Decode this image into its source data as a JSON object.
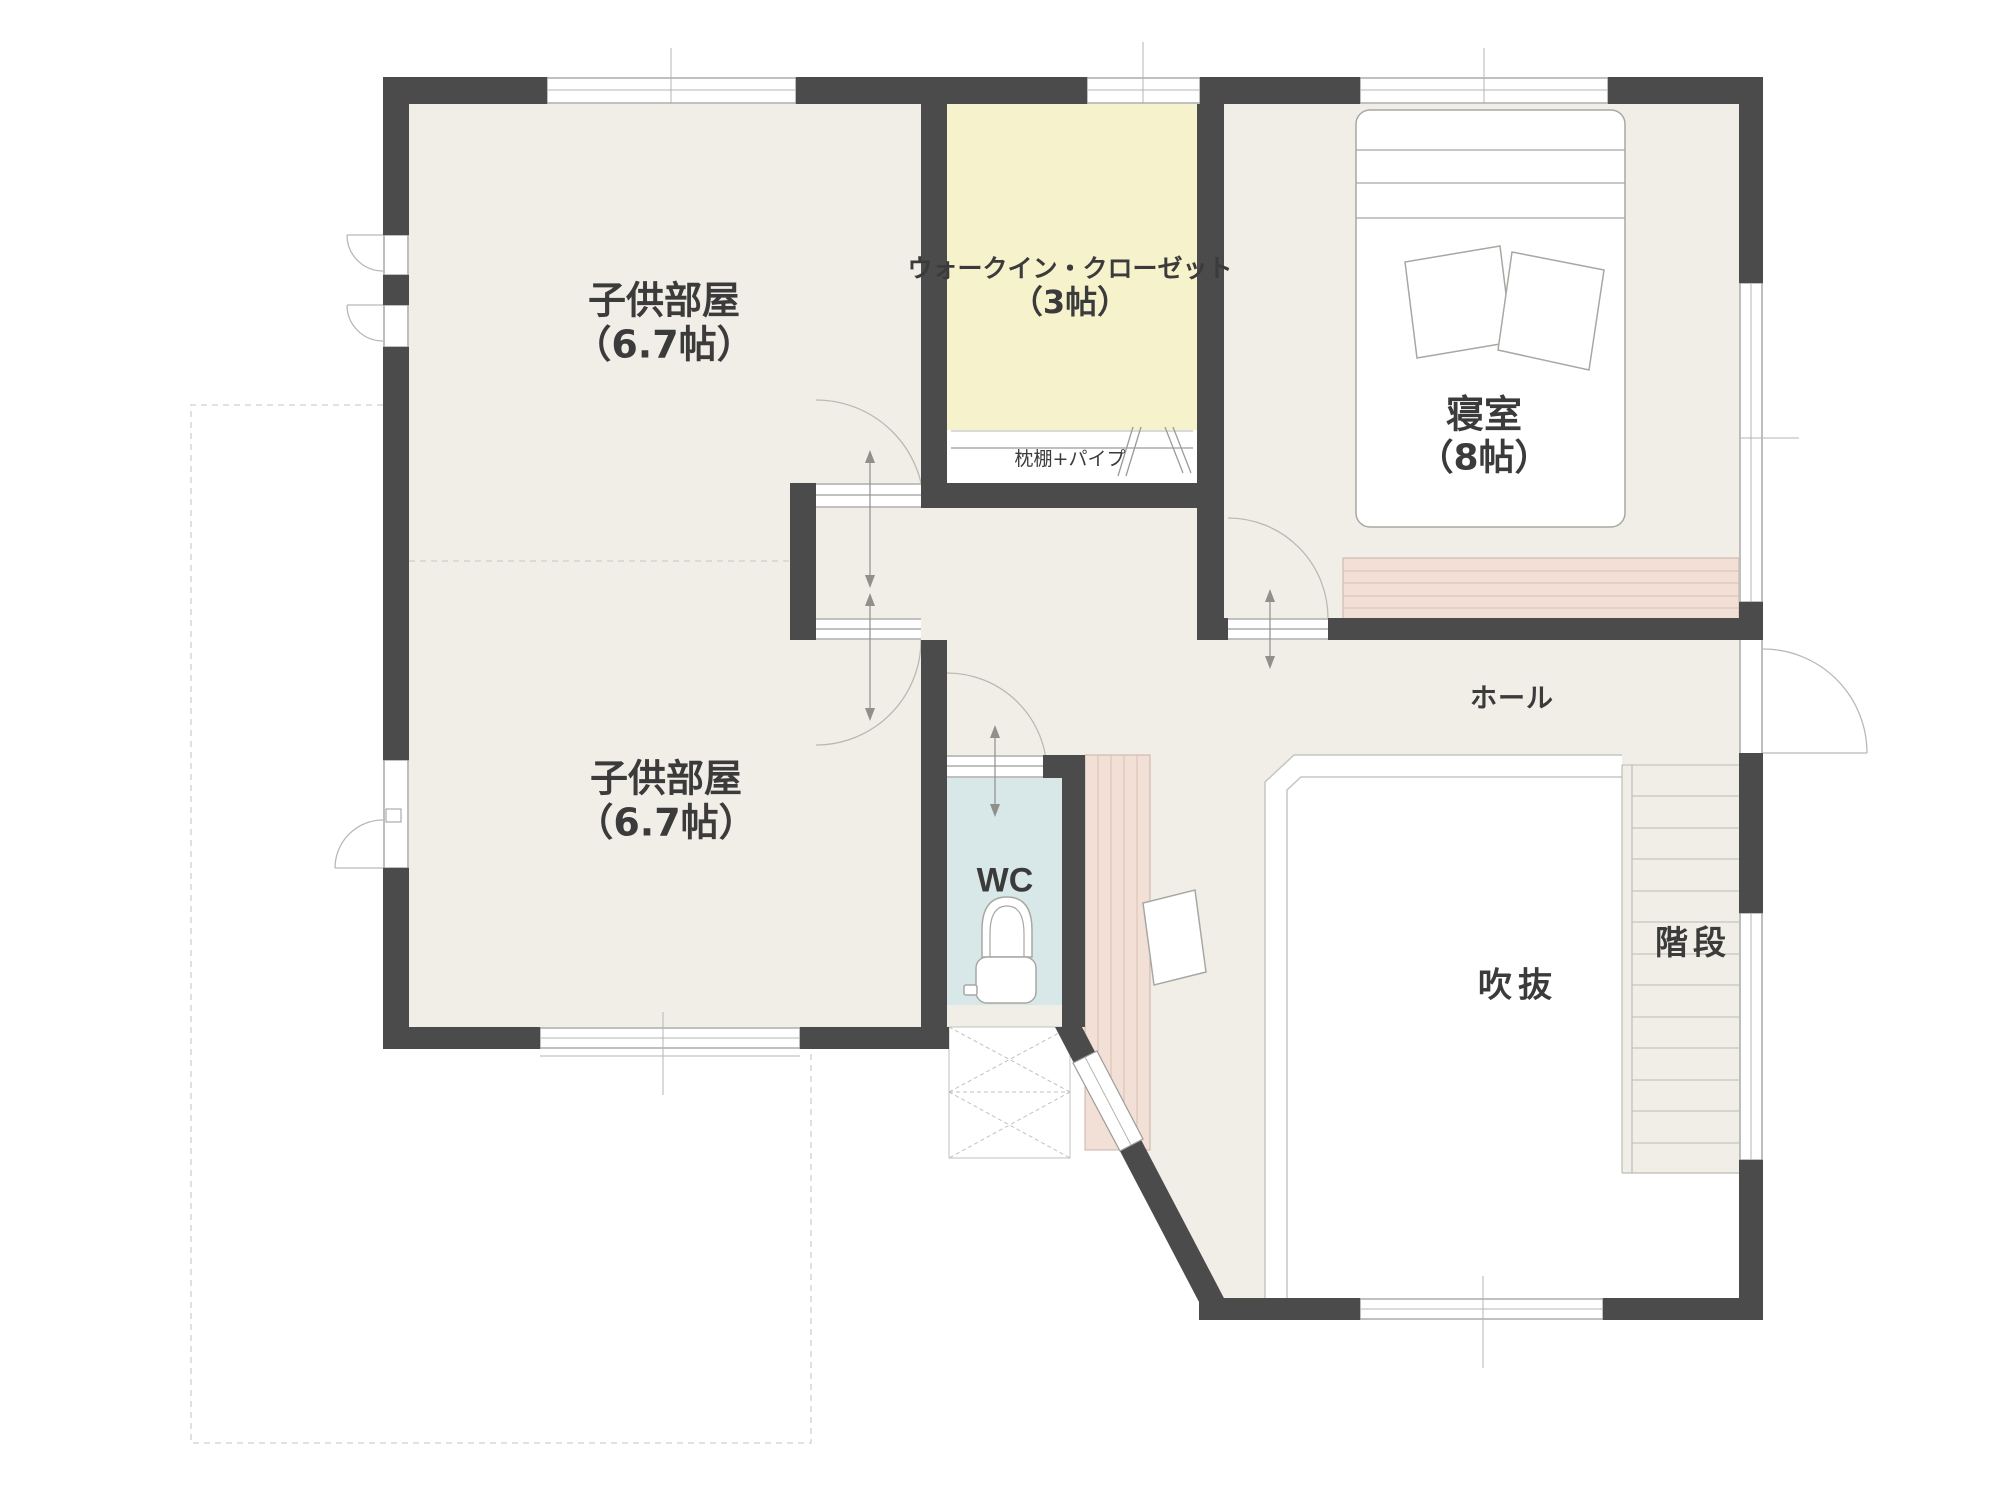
{
  "plan": {
    "rooms": {
      "kids_room_1": {
        "name": "子供部屋",
        "size": "（6.7帖）"
      },
      "kids_room_2": {
        "name": "子供部屋",
        "size": "（6.7帖）"
      },
      "walk_in_closet": {
        "name": "ウォークイン・クローゼット",
        "size": "（3帖）"
      },
      "bedroom": {
        "name": "寝室",
        "size": "（8帖）"
      },
      "wc": {
        "name": "WC"
      },
      "hall": {
        "name": "ホール"
      },
      "void": {
        "name": "吹抜"
      },
      "stairs": {
        "name": "階段"
      }
    },
    "annotations": {
      "closet_shelf": "枕棚+パイプ"
    }
  },
  "colors": {
    "wall": "#4c4b4b",
    "floor": "#f1eee7",
    "closet": "#f6f2cc",
    "wc": "#d8e7e8",
    "pink": "#f2dfd5",
    "pink-line": "#d9bfb2",
    "void": "#ffffff",
    "line": "#9b9b97",
    "text": "#3b3b3b"
  }
}
